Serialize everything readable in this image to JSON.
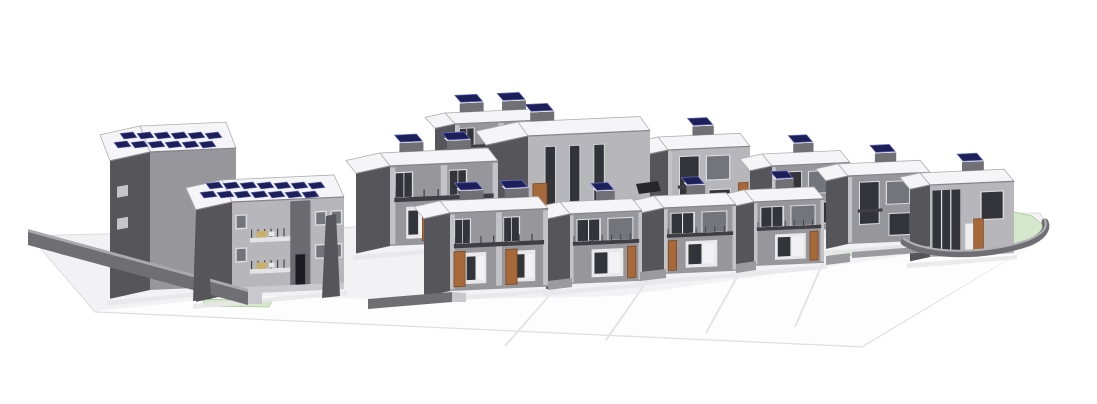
{
  "scene": {
    "title": "3D axonometric architectural site model of a residential development with apartment blocks, two rows of two-storey houses with rooftop solar panels, site retaining walls and landscaped terraces",
    "width": 1097,
    "height": 404,
    "background": "#ffffff"
  },
  "palette": {
    "ground": "#f2f2f4",
    "ground_edge": "#dcdcde",
    "apron": "#fdfdfe",
    "seam": "#e4e4e6",
    "lawn": "#d6e8cc",
    "lawn_edge": "#a9c89b",
    "shadow": "#e7e7e9",
    "wall_dark": "#55555a",
    "wall_dark2": "#6a6a6f",
    "wall_mid": "#96969b",
    "wall_light": "#b7b7bb",
    "pilaster": "#c3c3c7",
    "roof": "#f5f5f7",
    "parapet": "#b0b0b4",
    "parapet_dark": "#85858a",
    "bulkhead": "#707075",
    "solar": "#1d1f58",
    "solar_hi": "#6b70c4",
    "frame": "#dddde0",
    "glass_dark": "#33333a",
    "glass_mid": "#74747b",
    "porch": "#e9e9ec",
    "rail": "#3e3e44",
    "door": "#a8693a",
    "door_dark": "#1c1c22",
    "plinth": "#c9c9cd",
    "furniture": "#c9b169",
    "wall_top": "#aaaaae",
    "wall_face": "#6e6e73",
    "stub": "#9a9a9f",
    "stub_top": "#c6c6ca",
    "car": "#26262b"
  },
  "ground": {
    "platform": [
      [
        30,
        236
      ],
      [
        540,
        222
      ],
      [
        1040,
        213
      ],
      [
        1047,
        226
      ],
      [
        1040,
        240
      ],
      [
        862,
        347
      ],
      [
        95,
        312
      ]
    ],
    "apron": [
      [
        96,
        311
      ],
      [
        240,
        296
      ],
      [
        430,
        300
      ],
      [
        620,
        296
      ],
      [
        860,
        262
      ],
      [
        1000,
        242
      ],
      [
        1036,
        236
      ],
      [
        1044,
        238
      ],
      [
        862,
        346
      ]
    ],
    "seams": [
      {
        "a": [
          556,
          288
        ],
        "b": [
          505,
          346
        ]
      },
      {
        "a": [
          650,
          277
        ],
        "b": [
          606,
          340
        ]
      },
      {
        "a": [
          742,
          268
        ],
        "b": [
          706,
          333
        ]
      },
      {
        "a": [
          824,
          260
        ],
        "b": [
          795,
          327
        ]
      }
    ],
    "lawns": [
      {
        "pts": [
          [
            202,
            299
          ],
          [
            272,
            301
          ],
          [
            269,
            307
          ],
          [
            205,
            306
          ]
        ]
      },
      {
        "pts": [
          [
            652,
            187
          ],
          [
            742,
            181
          ],
          [
            743,
            186
          ],
          [
            652,
            192
          ]
        ]
      },
      {
        "pts": [
          [
            556,
            258
          ],
          [
            648,
            250
          ],
          [
            649,
            255
          ],
          [
            556,
            263
          ]
        ]
      },
      {
        "pts": [
          [
            662,
            252
          ],
          [
            758,
            245
          ],
          [
            759,
            249
          ],
          [
            662,
            256
          ]
        ]
      },
      {
        "pts": [
          [
            834,
            252
          ],
          [
            928,
            244
          ],
          [
            929,
            249
          ],
          [
            834,
            257
          ]
        ]
      },
      {
        "pts": [
          [
            918,
            216
          ],
          [
            965,
            210
          ],
          [
            1005,
            210
          ],
          [
            1032,
            216
          ],
          [
            1044,
            226
          ],
          [
            1040,
            237
          ],
          [
            1014,
            246
          ],
          [
            975,
            251
          ],
          [
            938,
            252
          ],
          [
            915,
            247
          ],
          [
            906,
            238
          ],
          [
            908,
            226
          ]
        ]
      }
    ],
    "back_walls": [
      {
        "pts": [
          [
            60,
            246
          ],
          [
            200,
            276
          ],
          [
            200,
            284
          ],
          [
            60,
            254
          ]
        ],
        "fill": "wall_mid"
      }
    ],
    "front_walls": [
      {
        "pts": [
          [
            28,
            229
          ],
          [
            248,
            289
          ],
          [
            248,
            293
          ],
          [
            28,
            235
          ]
        ],
        "fill": "wall_top"
      },
      {
        "pts": [
          [
            28,
            232
          ],
          [
            248,
            292
          ],
          [
            248,
            305
          ],
          [
            28,
            245
          ]
        ],
        "fill": "wall_face"
      },
      {
        "pts": [
          [
            248,
            290
          ],
          [
            262,
            292
          ],
          [
            262,
            304
          ],
          [
            248,
            304
          ]
        ],
        "fill": "plinth"
      },
      {
        "pts": [
          [
            368,
            299
          ],
          [
            452,
            292
          ],
          [
            452,
            302
          ],
          [
            368,
            309
          ]
        ],
        "fill": "wall_face"
      },
      {
        "pts": [
          [
            452,
            292
          ],
          [
            466,
            293
          ],
          [
            466,
            302
          ],
          [
            452,
            302
          ]
        ],
        "fill": "plinth"
      },
      {
        "pts": [
          [
            548,
            281
          ],
          [
            572,
            278
          ],
          [
            572,
            287
          ],
          [
            548,
            290
          ]
        ],
        "fill": "stub"
      },
      {
        "pts": [
          [
            640,
            272
          ],
          [
            666,
            269
          ],
          [
            666,
            278
          ],
          [
            640,
            281
          ]
        ],
        "fill": "stub"
      },
      {
        "pts": [
          [
            736,
            264
          ],
          [
            756,
            261
          ],
          [
            756,
            270
          ],
          [
            736,
            273
          ]
        ],
        "fill": "stub"
      },
      {
        "pts": [
          [
            826,
            256
          ],
          [
            850,
            253
          ],
          [
            850,
            262
          ],
          [
            826,
            265
          ]
        ],
        "fill": "stub"
      },
      {
        "pts": [
          [
            852,
            252
          ],
          [
            930,
            246
          ],
          [
            930,
            252
          ],
          [
            852,
            258
          ]
        ],
        "fill": "stub"
      }
    ],
    "fins": [
      {
        "pts": [
          [
            196,
            212
          ],
          [
            207,
            210
          ],
          [
            211,
            299
          ],
          [
            193,
            301
          ]
        ]
      },
      {
        "pts": [
          [
            326,
            216
          ],
          [
            336,
            214
          ],
          [
            340,
            296
          ],
          [
            322,
            298
          ]
        ]
      }
    ],
    "car": {
      "pts": [
        [
          636,
          184
        ],
        [
          658,
          181
        ],
        [
          661,
          191
        ],
        [
          639,
          194
        ]
      ]
    },
    "terrace_wall": {
      "outer": "M 904,242 C 928,258 988,257 1028,243 C 1043,237 1048,229 1045,222",
      "top": "M 904,239 C 928,255 988,254 1028,240 C 1043,234 1048,227 1045,220"
    }
  },
  "buildings": [
    {
      "id": "house-pair-rear-upper",
      "x": 455,
      "b": 178,
      "w": 92,
      "h": 54,
      "sw": 20,
      "rd": 11,
      "shade": "mid",
      "win": "front-pair",
      "door": [
        0.31,
        0.86
      ],
      "balc": true,
      "bulk": [
        0.16,
        0.62
      ],
      "solarRows": 0
    },
    {
      "id": "house-c",
      "x": 668,
      "b": 222,
      "w": 82,
      "h": 72,
      "sw": 24,
      "rd": 13,
      "shade": "light",
      "win": "big",
      "door": [
        0.86
      ],
      "balc": true,
      "bulk": [
        0.42
      ],
      "solarRows": 0
    },
    {
      "id": "house-block-b",
      "x": 528,
      "b": 232,
      "w": 122,
      "h": 96,
      "sw": 42,
      "rd": 14,
      "shade": "light",
      "win": "slits",
      "door": [
        0.04
      ],
      "balc": false,
      "bulk": [
        0.1
      ],
      "solarRows": 0
    },
    {
      "id": "house-d",
      "x": 772,
      "b": 232,
      "w": 78,
      "h": 66,
      "sw": 22,
      "rd": 12,
      "shade": "mid",
      "win": "big",
      "door": [
        0.86
      ],
      "balc": true,
      "bulk": [
        0.4
      ],
      "solarRows": 0
    },
    {
      "id": "house-e",
      "x": 848,
      "b": 244,
      "w": 82,
      "h": 68,
      "sw": 22,
      "rd": 12,
      "shade": "mid",
      "win": "big",
      "door": [
        0.85
      ],
      "balc": true,
      "bulk": [
        0.45
      ],
      "solarRows": 0
    },
    {
      "id": "house-pair-a",
      "x": 390,
      "b": 246,
      "w": 108,
      "h": 80,
      "sw": 34,
      "rd": 13,
      "shade": "mid",
      "win": "front-pair",
      "door": [
        0.3,
        0.88
      ],
      "balc": true,
      "bulk": [
        0.18,
        0.62
      ],
      "solarRows": 0
    },
    {
      "id": "house-f",
      "x": 930,
      "b": 257,
      "w": 84,
      "h": 72,
      "sw": 20,
      "rd": 12,
      "shade": "light",
      "win": "glass-left",
      "door": [
        0.52
      ],
      "balc": false,
      "bulk": [
        0.5
      ],
      "solarRows": 0
    },
    {
      "id": "front-house-4",
      "x": 754,
      "b": 266,
      "w": 70,
      "h": 64,
      "sw": 22,
      "rd": 12,
      "shade": "mid",
      "win": "front",
      "door": [
        0.8
      ],
      "balc": true,
      "bulk": [
        0.45
      ],
      "solarRows": 0
    },
    {
      "id": "front-house-3",
      "x": 664,
      "b": 274,
      "w": 72,
      "h": 66,
      "sw": 24,
      "rd": 12,
      "shade": "mid",
      "win": "front",
      "door": [
        0.06
      ],
      "balc": true,
      "bulk": [
        0.45
      ],
      "solarRows": 0
    },
    {
      "id": "front-house-2",
      "x": 570,
      "b": 284,
      "w": 72,
      "h": 70,
      "sw": 24,
      "rd": 12,
      "shade": "mid",
      "win": "front",
      "door": [
        0.8
      ],
      "balc": true,
      "bulk": [
        0.5
      ],
      "solarRows": 0
    },
    {
      "id": "apartment-block-rear",
      "x": 150,
      "b": 290,
      "w": 86,
      "h": 138,
      "sw": 40,
      "rd": 26,
      "shade": "mid",
      "win": "none",
      "door": [],
      "balc": false,
      "bulk": [],
      "solarRows": 2,
      "sideWin": true
    },
    {
      "id": "front-house-pair",
      "x": 450,
      "b": 291,
      "w": 98,
      "h": 78,
      "sw": 26,
      "rd": 12,
      "shade": "mid",
      "win": "front-pair",
      "door": [
        0.04,
        0.57
      ],
      "balc": true,
      "bulk": [
        0.2,
        0.66
      ],
      "solarRows": 0
    },
    {
      "id": "apartment-block-front",
      "x": 232,
      "b": 294,
      "w": 112,
      "h": 92,
      "sw": 36,
      "rd": 22,
      "shade": "light",
      "win": "apt",
      "door": [],
      "balc": false,
      "bulk": [],
      "solarRows": 2,
      "plinth": true
    }
  ]
}
